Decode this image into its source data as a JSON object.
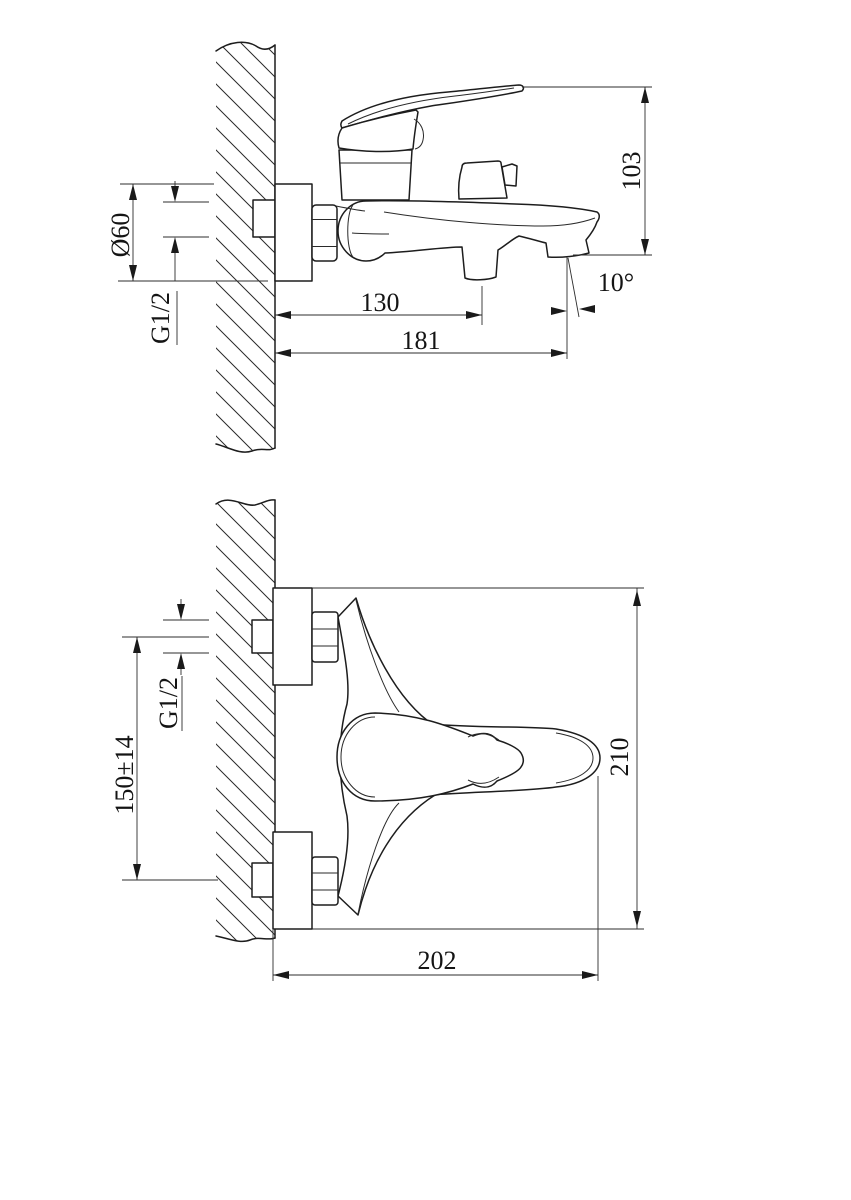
{
  "drawing": {
    "side_view": {
      "flange_diameter": "Ø60",
      "thread_size": "G1/2",
      "height": "103",
      "spout_projection": "130",
      "overall_projection": "181",
      "spout_angle": "10°"
    },
    "plan_view": {
      "thread_size": "G1/2",
      "mounting_centers": "150±14",
      "overall_height": "210",
      "overall_length": "202"
    }
  }
}
